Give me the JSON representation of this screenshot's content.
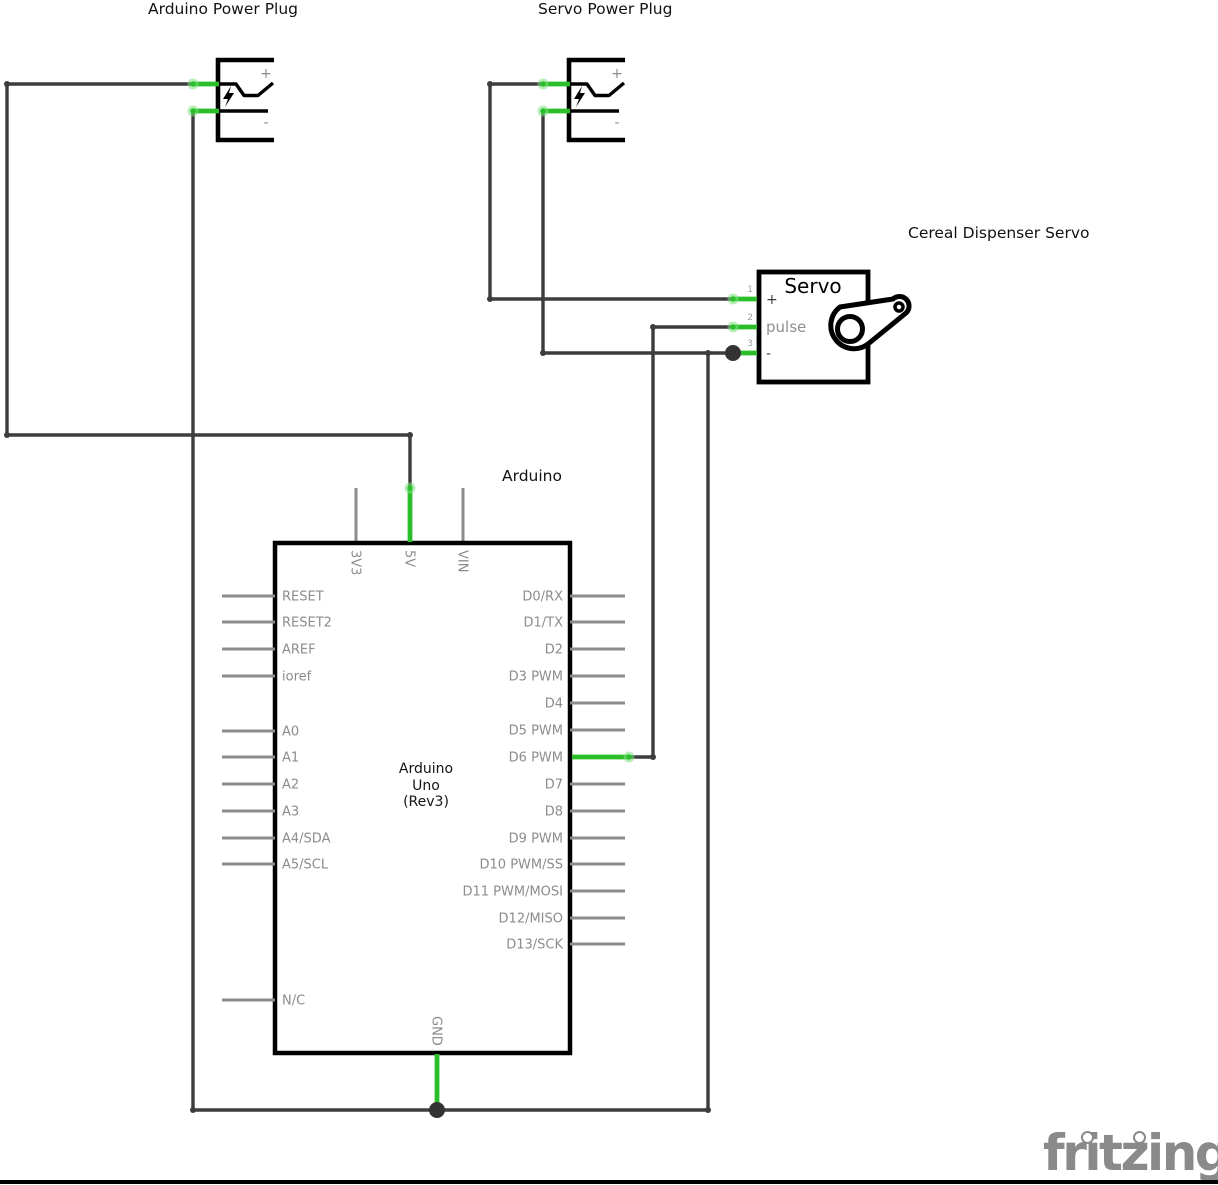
{
  "titles": {
    "arduino_power_plug": "Arduino Power Plug",
    "servo_power_plug": "Servo Power Plug",
    "cereal_servo": "Cereal Dispenser Servo",
    "arduino": "Arduino",
    "logo": "fritzing"
  },
  "colors": {
    "wire": "#3d3d3d",
    "junction": "#333333",
    "green": "#2abf2a",
    "green_glow": "#7ce07c",
    "pin": "#8c8c8c",
    "label": "#8c8c8c",
    "component": "#000000"
  },
  "schematic": {
    "wires": [
      [
        [
          193,
          84
        ],
        [
          7,
          84
        ],
        [
          7,
          435
        ],
        [
          410,
          435
        ],
        [
          410,
          489
        ]
      ],
      [
        [
          193,
          111
        ],
        [
          193,
          1110
        ]
      ],
      [
        [
          193,
          1110
        ],
        [
          708,
          1110
        ]
      ],
      [
        [
          708,
          1110
        ],
        [
          708,
          353
        ]
      ],
      [
        [
          543,
          353
        ],
        [
          734,
          353
        ]
      ],
      [
        [
          543,
          111
        ],
        [
          543,
          353
        ]
      ],
      [
        [
          543,
          84
        ],
        [
          490,
          84
        ],
        [
          490,
          299
        ],
        [
          738,
          299
        ]
      ],
      [
        [
          627,
          757
        ],
        [
          653,
          757
        ],
        [
          653,
          327
        ],
        [
          738,
          327
        ]
      ]
    ],
    "green_wires": [
      [
        [
          193,
          84
        ],
        [
          219,
          84
        ]
      ],
      [
        [
          193,
          111
        ],
        [
          219,
          111
        ]
      ],
      [
        [
          543,
          84
        ],
        [
          570,
          84
        ]
      ],
      [
        [
          543,
          111
        ],
        [
          570,
          111
        ]
      ],
      [
        [
          410,
          488
        ],
        [
          410,
          542
        ]
      ],
      [
        [
          437,
          1054
        ],
        [
          437,
          1110
        ]
      ],
      [
        [
          572,
          757
        ],
        [
          629,
          757
        ]
      ],
      [
        [
          733,
          299
        ],
        [
          757,
          299
        ]
      ],
      [
        [
          733,
          327
        ],
        [
          757,
          327
        ]
      ],
      [
        [
          733,
          353
        ],
        [
          757,
          353
        ]
      ]
    ],
    "green_dots": [
      [
        193,
        84
      ],
      [
        193,
        111
      ],
      [
        543,
        84
      ],
      [
        543,
        111
      ],
      [
        410,
        488
      ],
      [
        629,
        757
      ],
      [
        733,
        299
      ],
      [
        733,
        327
      ]
    ],
    "corner_dots": [
      [
        7,
        84
      ],
      [
        7,
        435
      ],
      [
        410,
        435
      ],
      [
        490,
        84
      ],
      [
        490,
        299
      ],
      [
        543,
        353
      ],
      [
        653,
        327
      ],
      [
        653,
        757
      ],
      [
        193,
        1110
      ],
      [
        708,
        1110
      ],
      [
        708,
        353
      ]
    ],
    "junctions": [
      [
        437,
        1110
      ],
      [
        733,
        353
      ]
    ],
    "plugs": [
      {
        "x": 218,
        "plus": "+",
        "minus": "-"
      },
      {
        "x": 569,
        "plus": "+",
        "minus": "-"
      }
    ],
    "arduino": {
      "box": [
        275,
        543,
        295,
        510
      ],
      "center_lines": [
        "Arduino",
        "Uno",
        "(Rev3)"
      ],
      "left_pins": [
        {
          "label": "RESET",
          "y": 596
        },
        {
          "label": "RESET2",
          "y": 622
        },
        {
          "label": "AREF",
          "y": 649
        },
        {
          "label": "ioref",
          "y": 676
        },
        {
          "label": "A0",
          "y": 731
        },
        {
          "label": "A1",
          "y": 757
        },
        {
          "label": "A2",
          "y": 784
        },
        {
          "label": "A3",
          "y": 811
        },
        {
          "label": "A4/SDA",
          "y": 838
        },
        {
          "label": "A5/SCL",
          "y": 864
        },
        {
          "label": "N/C",
          "y": 1000
        }
      ],
      "right_pins": [
        {
          "label": "D0/RX",
          "y": 596
        },
        {
          "label": "D1/TX",
          "y": 622
        },
        {
          "label": "D2",
          "y": 649
        },
        {
          "label": "D3 PWM",
          "y": 676
        },
        {
          "label": "D4",
          "y": 703
        },
        {
          "label": "D5 PWM",
          "y": 730
        },
        {
          "label": "D6 PWM",
          "y": 757,
          "connected": true
        },
        {
          "label": "D7",
          "y": 784
        },
        {
          "label": "D8",
          "y": 811
        },
        {
          "label": "D9 PWM",
          "y": 838
        },
        {
          "label": "D10 PWM/SS",
          "y": 864
        },
        {
          "label": "D11 PWM/MOSI",
          "y": 891
        },
        {
          "label": "D12/MISO",
          "y": 918
        },
        {
          "label": "D13/SCK",
          "y": 944
        }
      ],
      "top_pins": [
        {
          "label": "3V3",
          "x": 356
        },
        {
          "label": "5V",
          "x": 410,
          "connected": true
        },
        {
          "label": "VIN",
          "x": 463
        }
      ],
      "bottom_pins": [
        {
          "label": "GND",
          "x": 437,
          "connected": true
        }
      ]
    },
    "servo": {
      "box": [
        759,
        272,
        109,
        110
      ],
      "title": "Servo",
      "pins": [
        {
          "num": "1",
          "label": "+",
          "y": 299,
          "dark": true
        },
        {
          "num": "2",
          "label": "pulse",
          "y": 327
        },
        {
          "num": "3",
          "label": "-",
          "y": 353,
          "dark": true
        }
      ]
    }
  }
}
